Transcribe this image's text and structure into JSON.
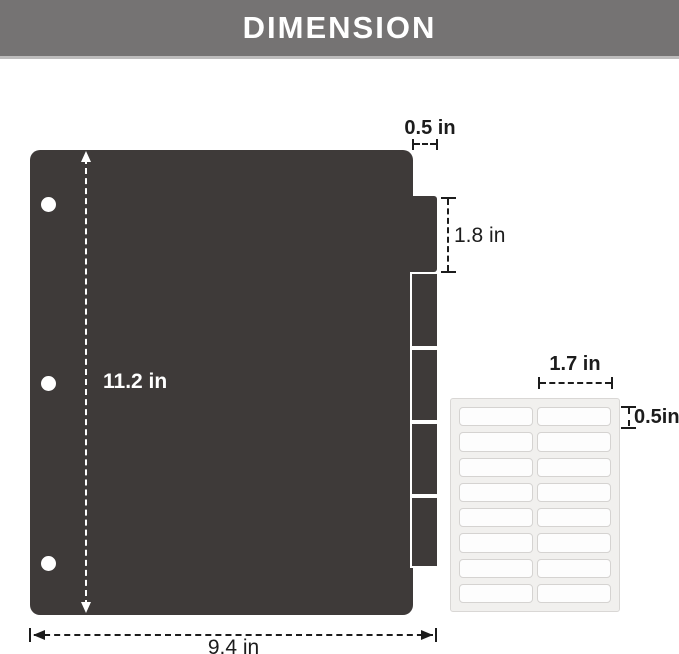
{
  "header": {
    "title": "DIMENSION",
    "bg_color": "#757373",
    "text_color": "#ffffff"
  },
  "divider_sheet": {
    "description": "dark binder divider sheet with punch holes and side tabs",
    "color": "#3e3a39",
    "hole_count": 3,
    "tab_count": 5,
    "height_label": "11.2 in",
    "width_label": "9.4 in",
    "tab_width_label": "0.5 in",
    "tab_height_label": "1.8 in"
  },
  "label_sheet": {
    "description": "sheet of blank white tab labels",
    "rows": 8,
    "columns": 2,
    "width_label": "1.7 in",
    "height_label": "0.5in",
    "sheet_color": "#f1f0ee",
    "label_color": "#fdfdfd"
  }
}
